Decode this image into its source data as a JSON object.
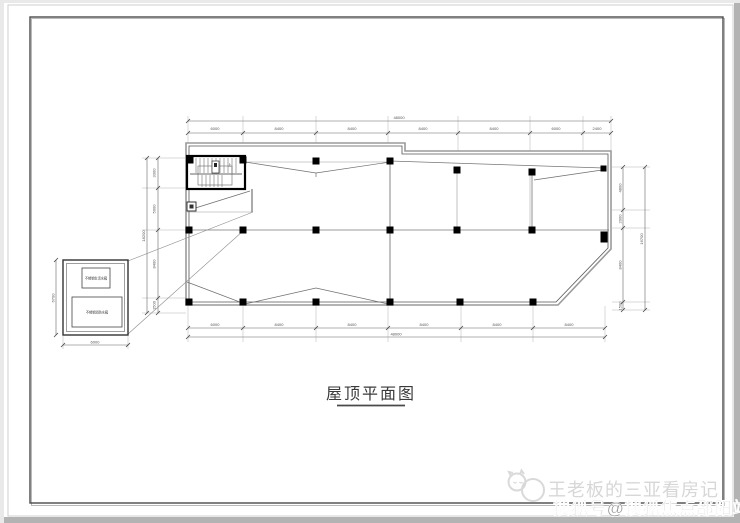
{
  "page": {
    "title": "屋顶平面图",
    "watermark": {
      "line1": "王老板的三亚看房记",
      "line2": "搜狐号@搜狐焦点邵阳站",
      "logo": "cat-face-logo"
    }
  },
  "dimensions": {
    "top": {
      "total": "48000",
      "segments": [
        "6000",
        "8400",
        "8400",
        "8400",
        "8400",
        "6000",
        "2400"
      ]
    },
    "bottom": {
      "total": "48000",
      "segments": [
        "6000",
        "8400",
        "8400",
        "8400",
        "8400",
        "8400"
      ]
    },
    "left": {
      "total": "18200",
      "segments": [
        "3300",
        "5000",
        "8400",
        "1500"
      ]
    },
    "right": {
      "total": "16700",
      "segments": [
        "4800",
        "2000",
        "8400",
        "1500"
      ]
    }
  },
  "detail_box": {
    "label_top": "不锈钢生活水箱",
    "label_bottom": "不锈钢消防水箱",
    "dim_width": "6000",
    "dim_height": "6700"
  },
  "stair": {
    "label": "上"
  },
  "colors": {
    "watermark_light": "#d7d7d7",
    "watermark_dark": "#8d8d8d",
    "frame_dark": "#4a4a4a",
    "line_dark": "#1a1a1a"
  }
}
